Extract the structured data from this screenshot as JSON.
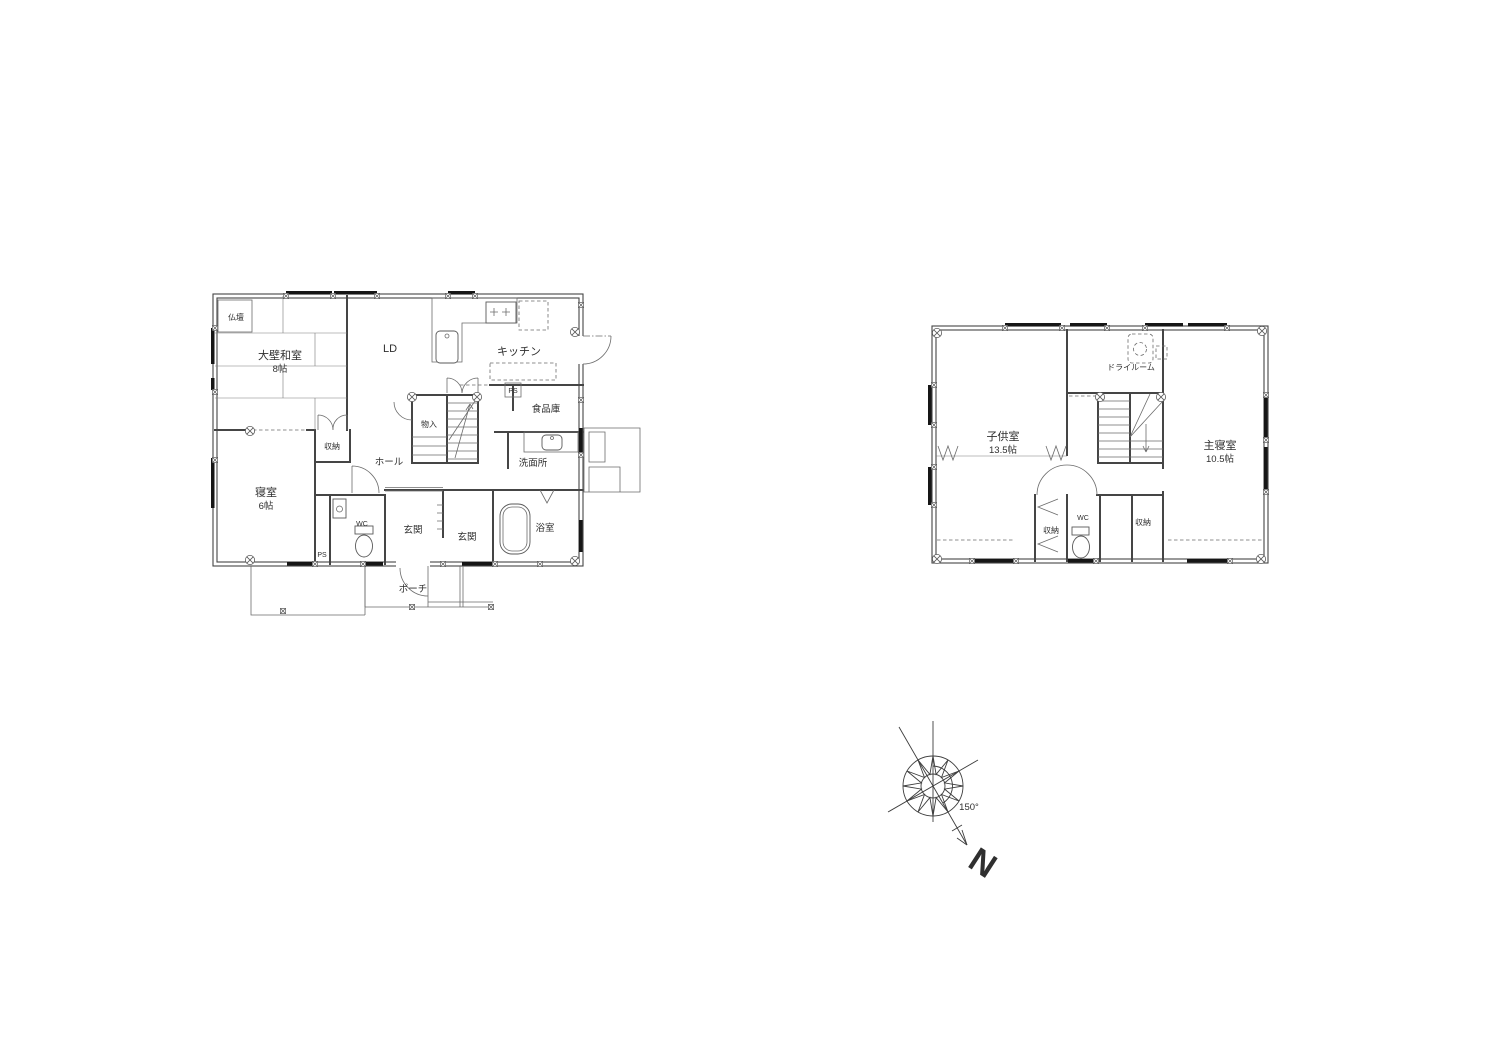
{
  "floor1": {
    "labels": {
      "butsudan": "仏壇",
      "washitsu": "大壁和室",
      "washitsu_size": "8帖",
      "ld": "LD",
      "kitchen": "キッチン",
      "pantry": "食品庫",
      "ps_pantry": "PS",
      "monoire": "物入",
      "hall": "ホール",
      "senmenjo": "洗面所",
      "shuno": "収納",
      "bedroom": "寝室",
      "bedroom_size": "6帖",
      "wc": "WC",
      "ps_wc": "PS",
      "genkan_inner": "玄関",
      "genkan_outer": "玄関",
      "bath": "浴室",
      "porch": "ポーチ"
    }
  },
  "floor2": {
    "labels": {
      "kids_room": "子供室",
      "kids_room_size": "13.5帖",
      "dry_room": "ドライルーム",
      "master_bedroom": "主寝室",
      "master_bedroom_size": "10.5帖",
      "closet_left": "収納",
      "wc": "WC",
      "closet_right": "収納"
    }
  },
  "compass": {
    "angle": "150°",
    "north": "N"
  },
  "colors": {
    "line": "#454545",
    "window": "#161616",
    "text": "#2f2f2f",
    "background": "#ffffff"
  }
}
